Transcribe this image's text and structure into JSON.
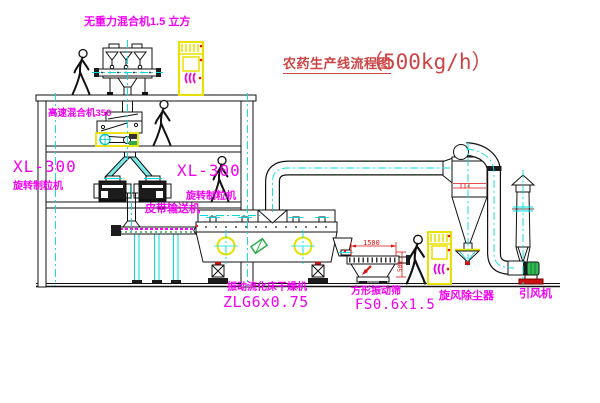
{
  "title": {
    "text": "农药生产线流程图",
    "capacity": "（500kg/h）"
  },
  "equipment_labels": {
    "gravity_mixer": "无重力混合机1.5 立方",
    "high_speed_mixer": "高速混合机350",
    "granulator_left": {
      "model": "XL-300",
      "name": "旋转制粒机"
    },
    "granulator_mid": {
      "model": "XL-300",
      "name": "旋转制粒机"
    },
    "belt_conveyor": "皮带输送机",
    "fluid_bed_dryer": {
      "name": "振动流化床干燥机",
      "model": "ZLG6x0.75"
    },
    "square_sieve": {
      "name": "方形振动筛",
      "model": "FS0.6x1.5"
    },
    "cyclone": "旋风除尘器",
    "induced_draft_fan": "引风机"
  },
  "dimensions": {
    "sieve_width": "1500",
    "sieve_height": "500"
  },
  "colors": {
    "label_magenta": "#f500f5",
    "title_red": "#cc4444",
    "centerline_cyan": "#00dcdc",
    "highlight_yellow": "#e8e000",
    "dimension_red": "#dd1111",
    "machine_green": "#2faa4a"
  }
}
